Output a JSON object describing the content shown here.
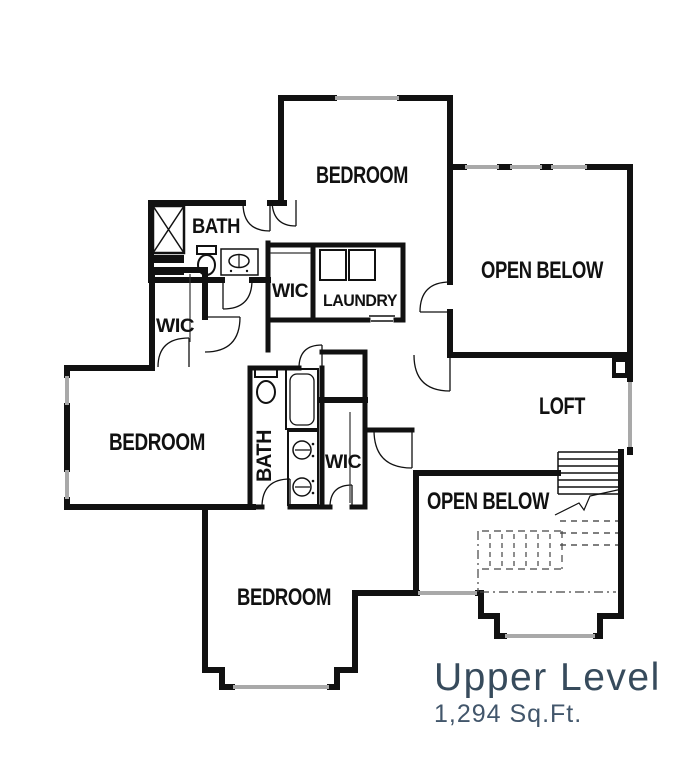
{
  "plan": {
    "title": "Upper Level",
    "area": "1,294 Sq.Ft."
  },
  "rooms": {
    "bedroom_top": "BEDROOM",
    "bedroom_left": "BEDROOM",
    "bedroom_bottom": "BEDROOM",
    "bath_top": "BATH",
    "bath_center": "BATH",
    "wic_top": "WIC",
    "wic_left": "WIC",
    "wic_center": "WIC",
    "laundry": "LAUNDRY",
    "open_below_top": "OPEN BELOW",
    "open_below_bottom": "OPEN BELOW",
    "loft": "LOFT"
  },
  "fixtures": [
    "shower",
    "toilet",
    "vanity-sink",
    "washer",
    "dryer",
    "bathtub",
    "double-vanity",
    "staircase",
    "linen-shelves",
    "closet-rods"
  ],
  "colors": {
    "wall": "#111111",
    "window": "#a9a9a9",
    "title_text": "#374b5c",
    "area_text": "#42566b",
    "background": "#ffffff"
  }
}
